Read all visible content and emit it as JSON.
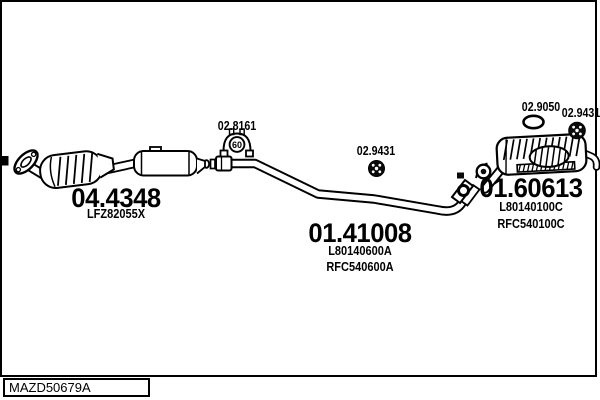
{
  "parts": {
    "catalytic_converter": {
      "number": "04.4348",
      "oem": "LFZ82055X"
    },
    "centre_pipe": {
      "number": "01.41008",
      "oem_codes": [
        "L80140600A",
        "RFC540600A"
      ]
    },
    "rear_silencer": {
      "number": "01.60613",
      "oem_codes": [
        "L80140100C",
        "RFC540100C"
      ]
    },
    "clamp": {
      "number": "02.8161",
      "diameter_label": "60"
    },
    "rubber_hanger_centre": {
      "number": "02.9431"
    },
    "gasket": {
      "number": "02.9050"
    },
    "rubber_hanger_rear": {
      "number": "02.9431"
    }
  },
  "footer": {
    "drawing_code": "MAZD50679A"
  },
  "colors": {
    "line": "#000000",
    "background": "#ffffff"
  }
}
